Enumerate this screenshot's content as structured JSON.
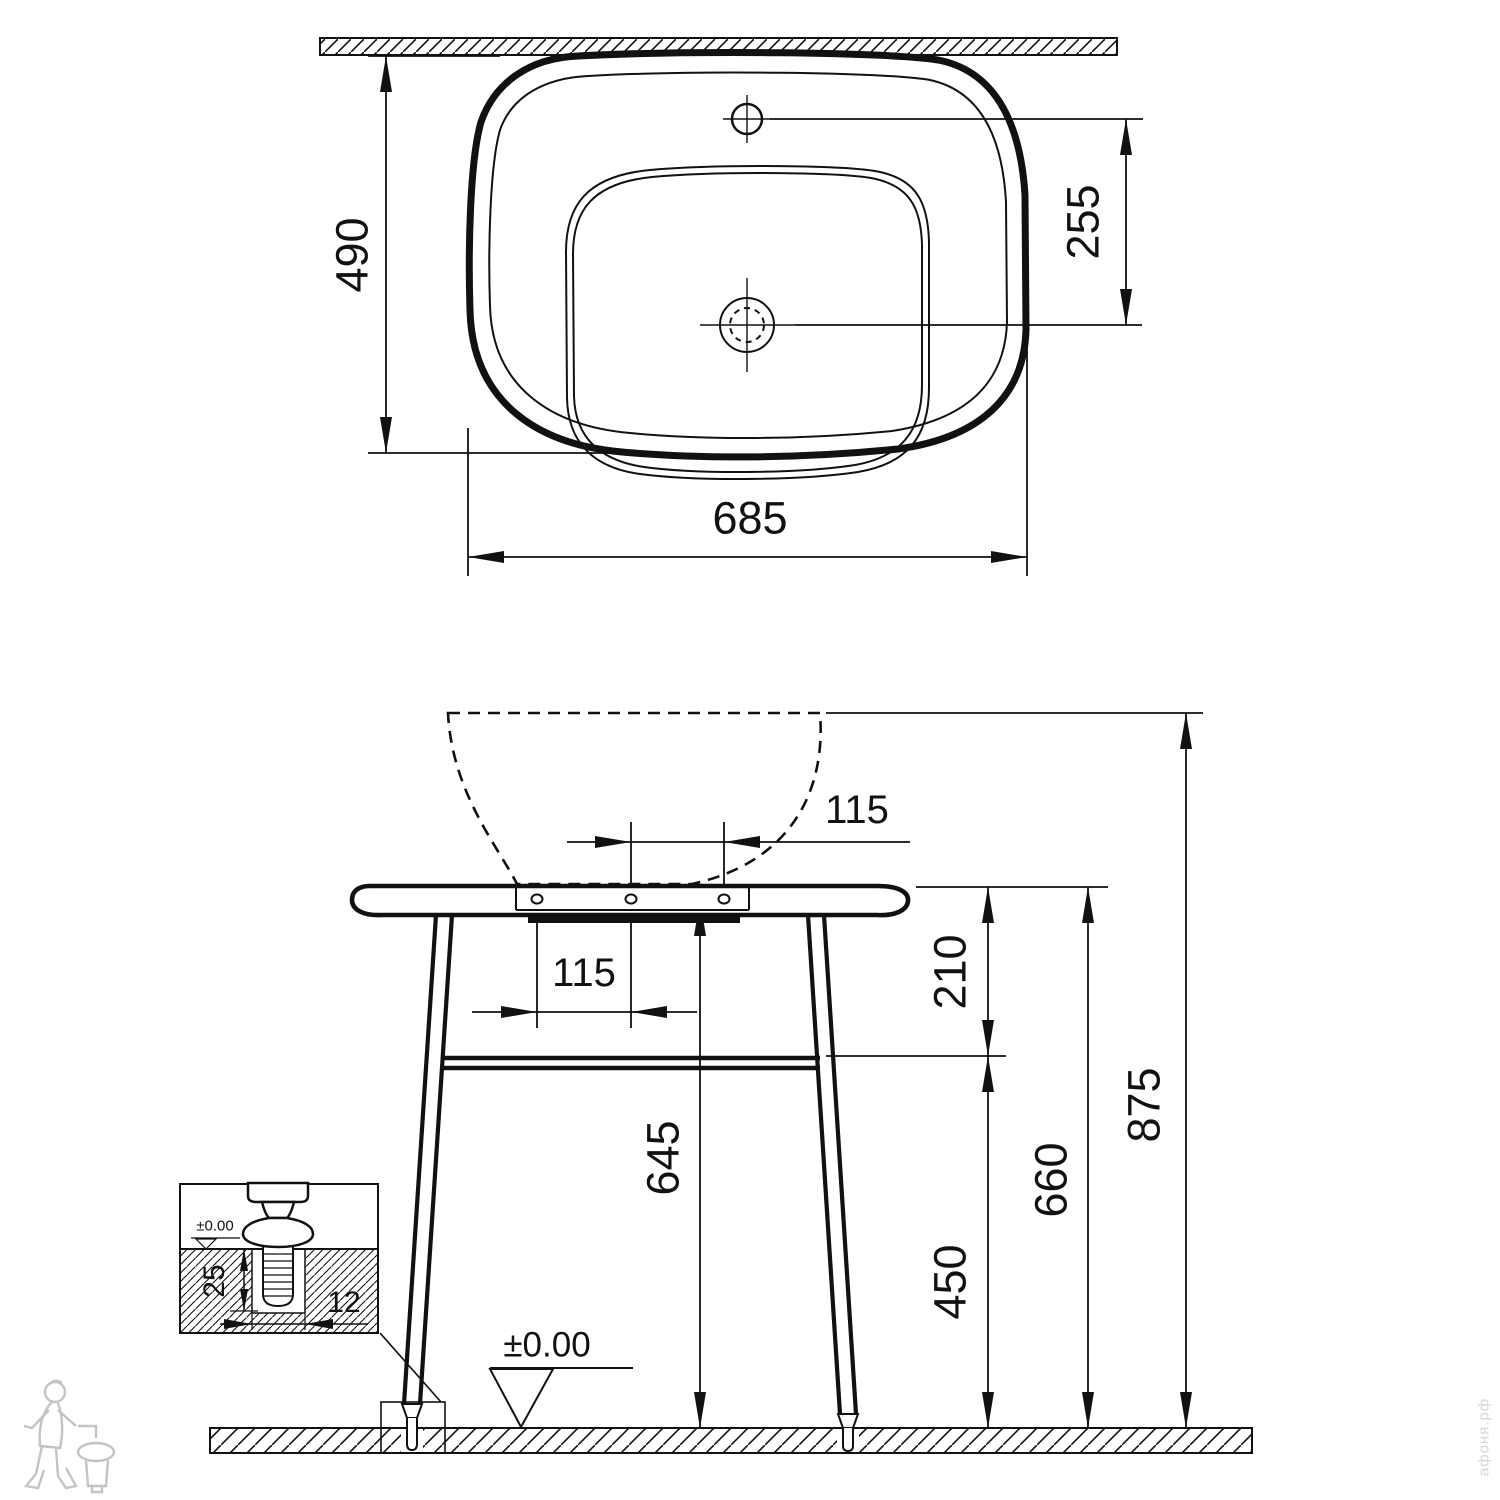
{
  "drawing": {
    "top_view": {
      "depth_label": "490",
      "width_label": "685",
      "faucet_to_drain_label": "255"
    },
    "front_view": {
      "hole_spacing_right_label": "115",
      "hole_spacing_left_label": "115",
      "tabletop_to_shelf_label": "210",
      "total_height_label": "875",
      "tabletop_height_label": "660",
      "shelf_height_label": "450",
      "underside_height_label": "645",
      "floor_level_label": "±0.00"
    },
    "detail_inset": {
      "floor_level_label": "±0.00",
      "anchor_depth_label": "25",
      "anchor_width_label": "12"
    },
    "watermark": {
      "site_text": "афоня.рф"
    }
  }
}
